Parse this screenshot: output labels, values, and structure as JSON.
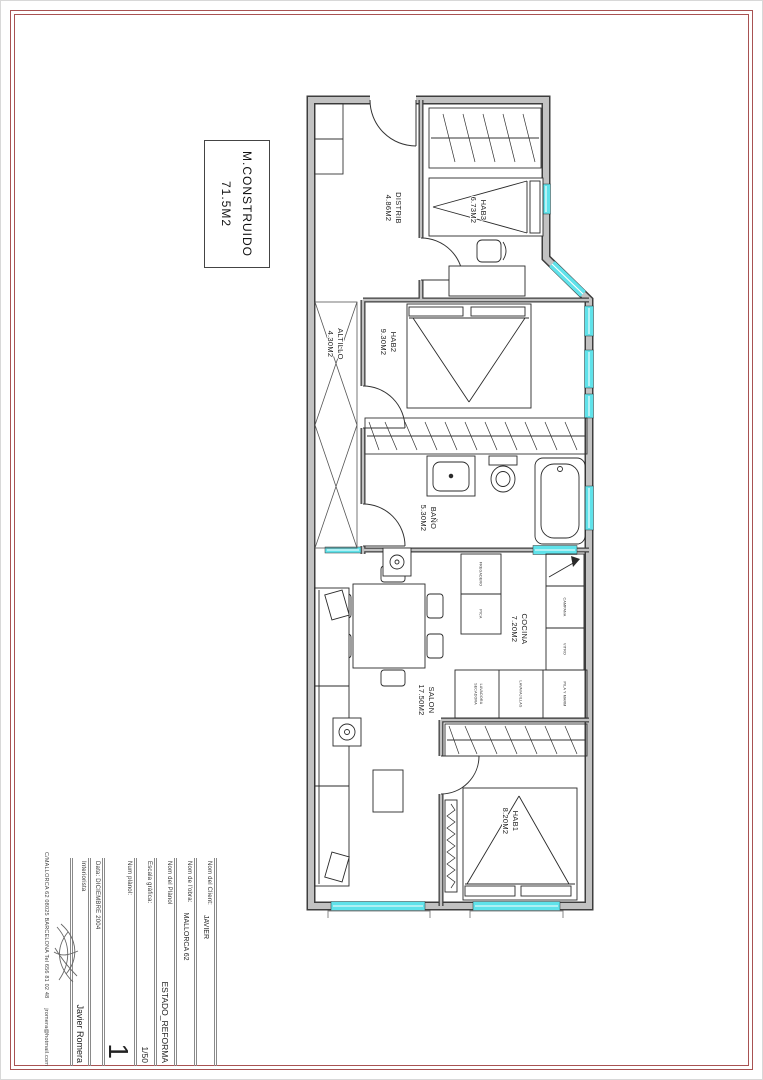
{
  "sheet": {
    "title_box": {
      "line1": "M.CONSTRUIDO",
      "line2": "71.5M2"
    },
    "plan": {
      "rooms": [
        {
          "id": "distrib",
          "name": "DISTRIB",
          "area": "4.86M2"
        },
        {
          "id": "hab3",
          "name": "HAB3",
          "area": "6.73M2"
        },
        {
          "id": "hab2",
          "name": "HAB2",
          "area": "9.30M2"
        },
        {
          "id": "altillo",
          "name": "ALTILLO",
          "area": "4.30M2"
        },
        {
          "id": "bano",
          "name": "BAÑO",
          "area": "5.30M2"
        },
        {
          "id": "cocina",
          "name": "COCINA",
          "area": "7.20M2"
        },
        {
          "id": "salon",
          "name": "SALON",
          "area": "17.50M2"
        },
        {
          "id": "hab1",
          "name": "HAB1",
          "area": "8.20M2"
        }
      ],
      "kitchen": {
        "hood": "CAMPANA",
        "hob": "VITRO",
        "unit_a": "FREGADERO",
        "unit_b": "PICA",
        "col_top": "PILA Y MARM",
        "col_mid": "LAVAVAJILLAS",
        "col_bot1": "LAVADORA",
        "col_bot2": "SECADORA"
      }
    },
    "title_block": {
      "rows": [
        {
          "label": "Nom del Client:",
          "value": "JAVIER"
        },
        {
          "label": "Nom de l'obra:",
          "value": "MALLORCA 62"
        },
        {
          "label": "Nom del Plànol",
          "value": "ESTADO_REFORMA"
        },
        {
          "label": "Escala gràfica:",
          "value": "1/50"
        },
        {
          "label": "Num plànol:",
          "value": "1"
        },
        {
          "label": "Data: DICIEMBRE 2004",
          "value": ""
        },
        {
          "label": "Interiorista",
          "value": "Javier Romera"
        }
      ]
    },
    "contact_line": "C/MALLORCA 62    08025 BARCELONA    Tel 656 81 02 48",
    "contact_email": "jromera@hotmail.com",
    "colors": {
      "frame_red": "#a85252",
      "wall_gray": "#c2c2c2",
      "wall_dark": "#3d3d3d",
      "window_cyan": "#5fe2ea",
      "line_black": "#2a2a2a"
    }
  }
}
